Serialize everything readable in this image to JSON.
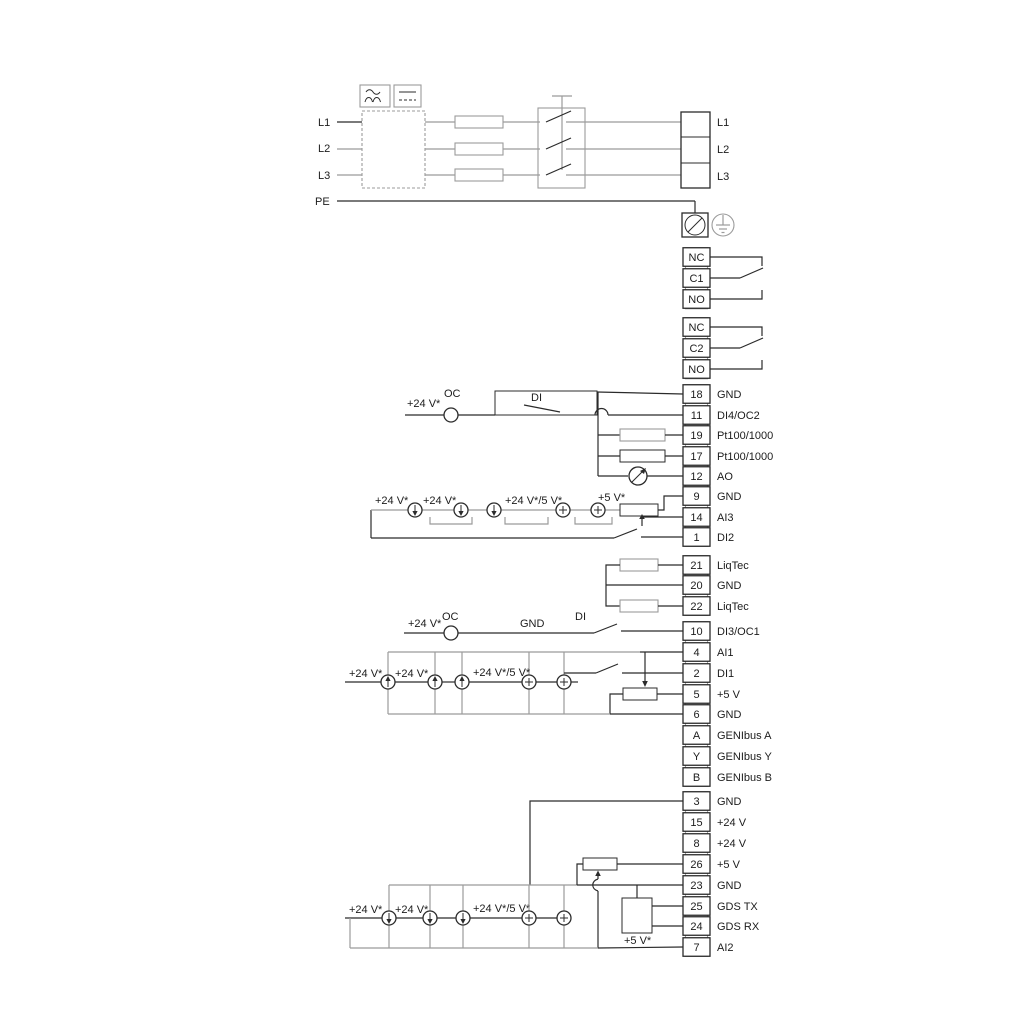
{
  "mains": {
    "left": [
      "L1",
      "L2",
      "L3"
    ],
    "pe": "PE",
    "right": [
      "L1",
      "L2",
      "L3"
    ]
  },
  "relay1": [
    "NC",
    "C1",
    "NO"
  ],
  "relay2": [
    "NC",
    "C2",
    "NO"
  ],
  "io1": [
    {
      "no": "18",
      "label": "GND"
    },
    {
      "no": "11",
      "label": "DI4/OC2"
    },
    {
      "no": "19",
      "label": "Pt100/1000"
    },
    {
      "no": "17",
      "label": "Pt100/1000"
    },
    {
      "no": "12",
      "label": "AO"
    },
    {
      "no": "9",
      "label": "GND"
    },
    {
      "no": "14",
      "label": "AI3"
    },
    {
      "no": "1",
      "label": "DI2"
    }
  ],
  "liqtec": [
    {
      "no": "21",
      "label": "LiqTec"
    },
    {
      "no": "20",
      "label": "GND"
    },
    {
      "no": "22",
      "label": "LiqTec"
    }
  ],
  "io2": [
    {
      "no": "10",
      "label": "DI3/OC1"
    },
    {
      "no": "4",
      "label": "AI1"
    },
    {
      "no": "2",
      "label": "DI1"
    },
    {
      "no": "5",
      "label": "+5 V"
    },
    {
      "no": "6",
      "label": "GND"
    },
    {
      "no": "A",
      "label": "GENIbus A"
    },
    {
      "no": "Y",
      "label": "GENIbus Y"
    },
    {
      "no": "B",
      "label": "GENIbus B"
    }
  ],
  "io3": [
    {
      "no": "3",
      "label": "GND"
    },
    {
      "no": "15",
      "label": "+24 V"
    },
    {
      "no": "8",
      "label": "+24 V"
    },
    {
      "no": "26",
      "label": "+5 V"
    },
    {
      "no": "23",
      "label": "GND"
    },
    {
      "no": "25",
      "label": "GDS TX"
    },
    {
      "no": "24",
      "label": "GDS RX"
    },
    {
      "no": "7",
      "label": "AI2"
    }
  ],
  "notes": {
    "a_24v": "+24 V*",
    "a_oc": "OC",
    "a_di": "DI",
    "b_24v_1": "+24 V*",
    "b_24v_2": "+24 V*",
    "b_mix": "+24 V*/5 V*",
    "b_5v": "+5 V*",
    "c_24v": "+24 V*",
    "c_oc": "OC",
    "c_gnd": "GND",
    "c_di": "DI",
    "c_24v_1": "+24 V*",
    "c_24v_2": "+24 V*",
    "c_mix": "+24 V*/5 V*",
    "d_24v_1": "+24 V*",
    "d_24v_2": "+24 V*",
    "d_mix": "+24 V*/5 V*",
    "d_5v": "+5 V*"
  },
  "colors": {
    "ink": "#2b2b2b",
    "wire_gray": "#9b9b9b"
  }
}
